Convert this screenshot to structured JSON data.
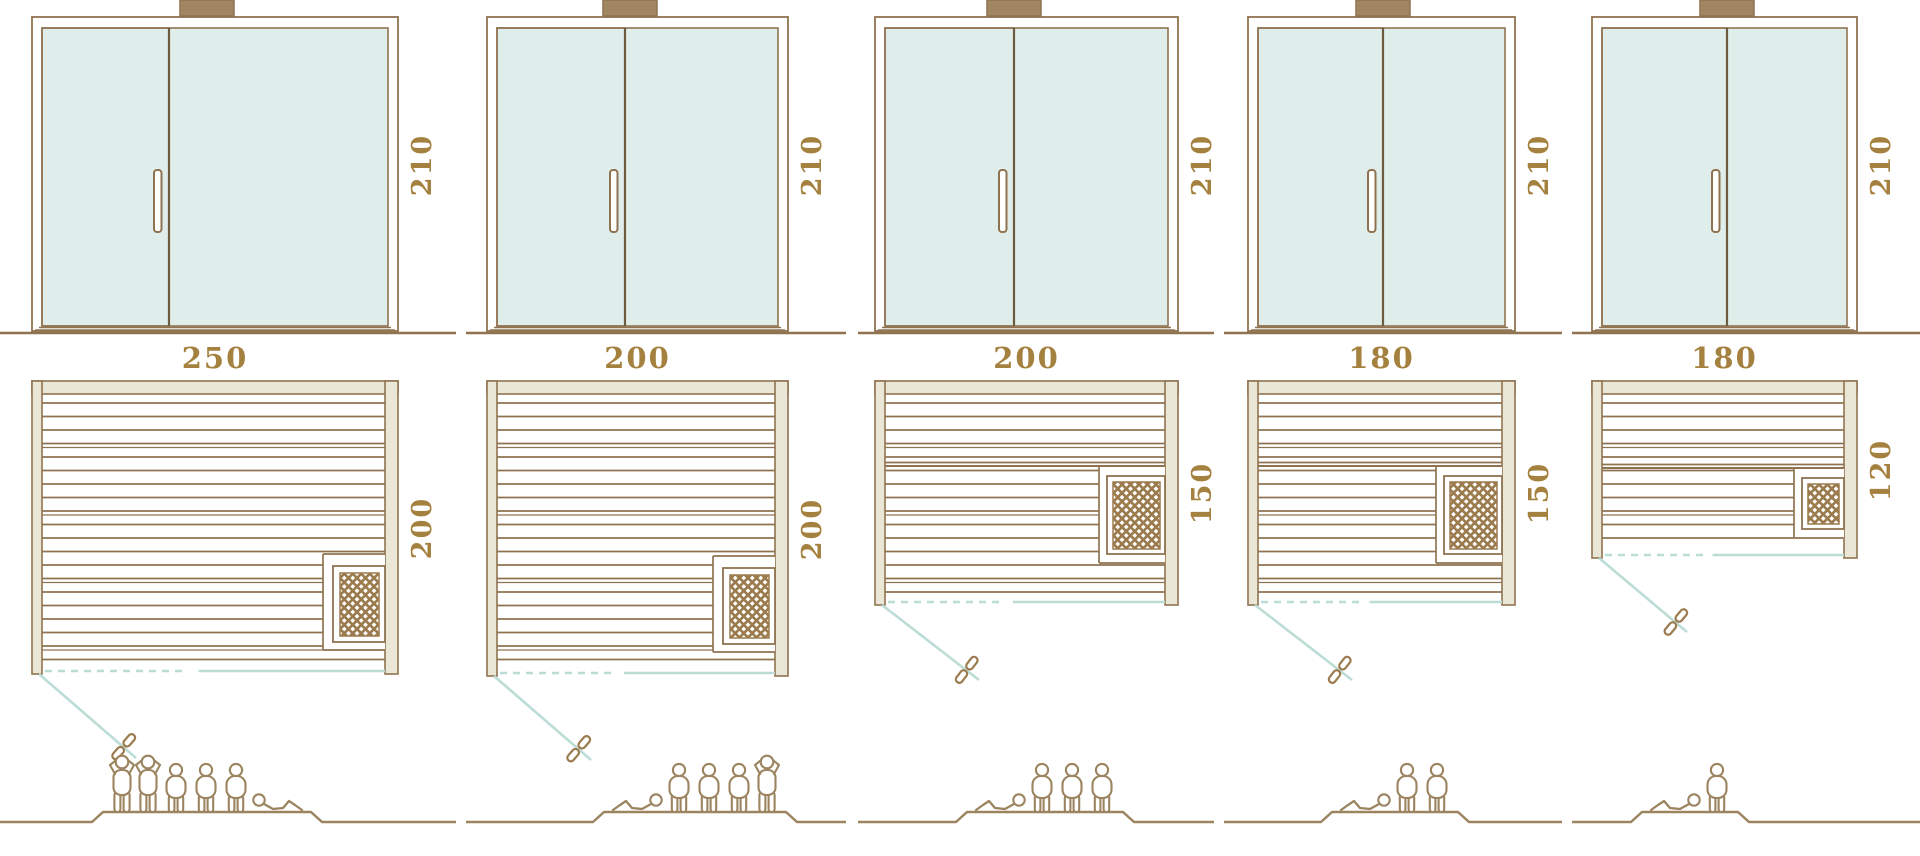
{
  "diagram": {
    "title": "Sauna cabin size comparison - door elevations, floor plans and capacity",
    "colors": {
      "outline": "#8f7350",
      "people_line": "#9b845f",
      "label": "#a5813f",
      "wall_fill": "#eae7d6",
      "glass": "#dfeeea",
      "teal": "#bcdcd6",
      "hatch": "#9b7b4e",
      "block_fill": "#a08663",
      "divider": "#6e5a3e"
    },
    "units": [
      {
        "id": "sauna-250x200",
        "elevation": {
          "height_label": "210"
        },
        "plan": {
          "width_label": "250",
          "depth_label": "200",
          "heater": "bottom-right"
        },
        "capacity": {
          "total": 6,
          "standing": 2,
          "sitting": 3,
          "lying": 1
        }
      },
      {
        "id": "sauna-200x200",
        "elevation": {
          "height_label": "210"
        },
        "plan": {
          "width_label": "200",
          "depth_label": "200",
          "heater": "bottom-right"
        },
        "capacity": {
          "total": 5,
          "standing": 1,
          "sitting": 3,
          "lying": 1
        }
      },
      {
        "id": "sauna-200x150",
        "elevation": {
          "height_label": "210"
        },
        "plan": {
          "width_label": "200",
          "depth_label": "150",
          "heater": "right-middle"
        },
        "capacity": {
          "total": 4,
          "standing": 0,
          "sitting": 3,
          "lying": 1
        }
      },
      {
        "id": "sauna-180x150",
        "elevation": {
          "height_label": "210"
        },
        "plan": {
          "width_label": "180",
          "depth_label": "150",
          "heater": "right-middle"
        },
        "capacity": {
          "total": 3,
          "standing": 0,
          "sitting": 2,
          "lying": 1
        }
      },
      {
        "id": "sauna-180x120",
        "elevation": {
          "height_label": "210"
        },
        "plan": {
          "width_label": "180",
          "depth_label": "120",
          "heater": "right-middle"
        },
        "capacity": {
          "total": 2,
          "standing": 0,
          "sitting": 1,
          "lying": 1
        }
      }
    ]
  }
}
